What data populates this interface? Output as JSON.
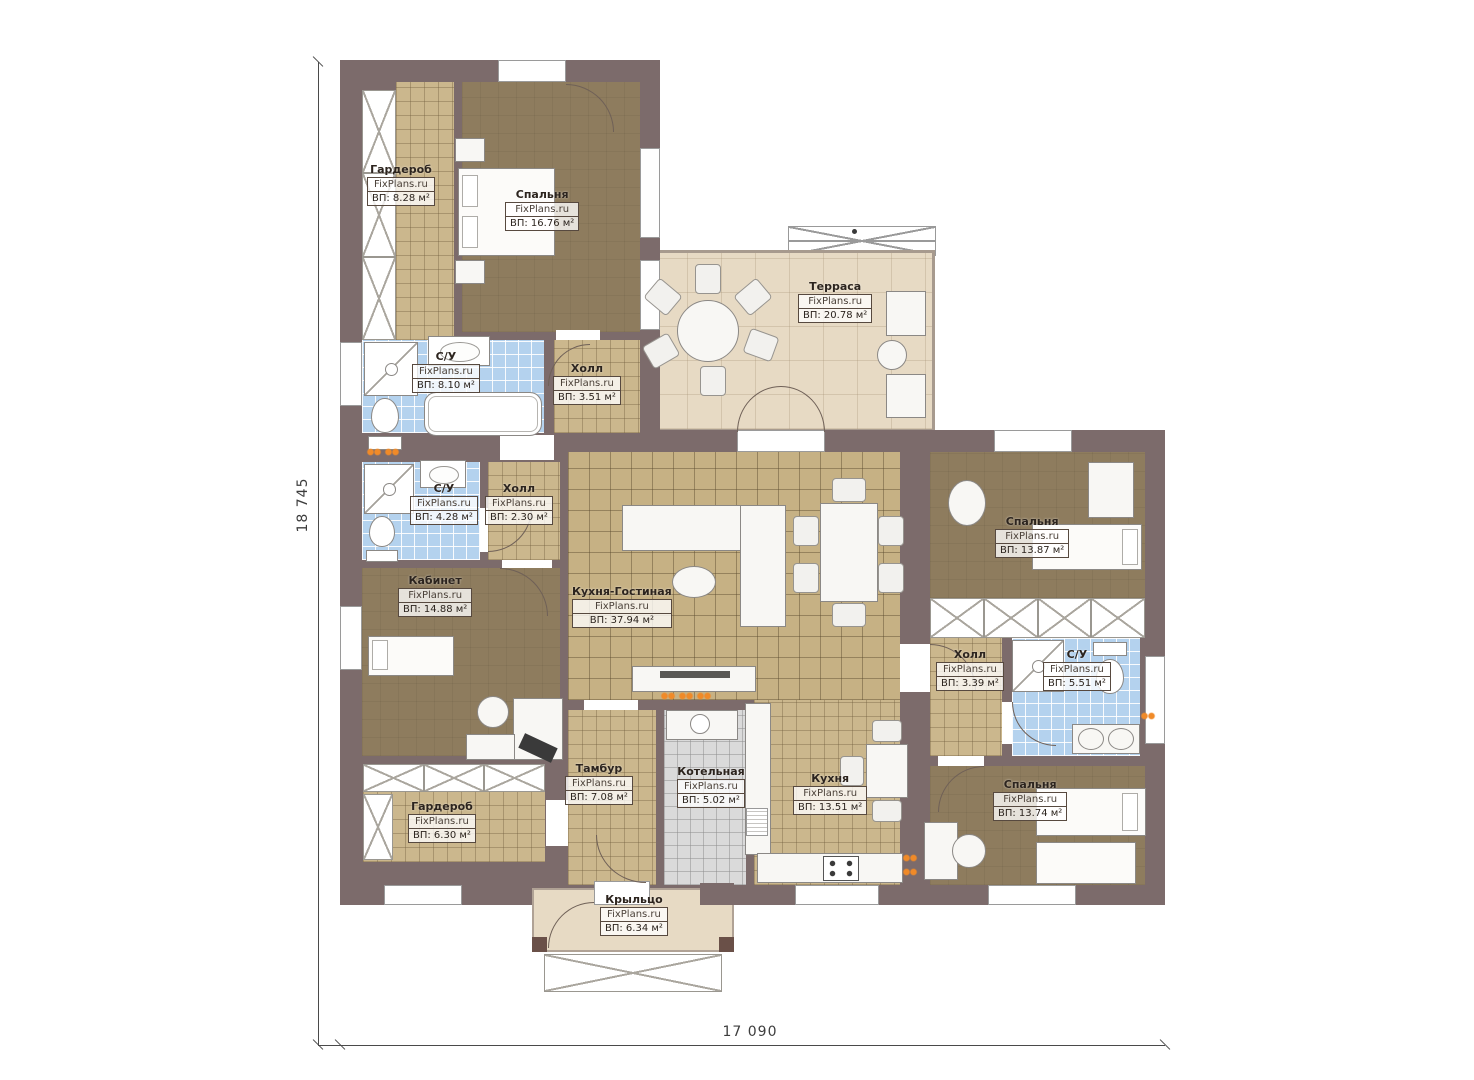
{
  "plan": {
    "watermark": "FixPlans.ru",
    "dimensions": {
      "height_label": "18 745",
      "width_label": "17 090"
    },
    "rooms": [
      {
        "id": "garderob-1",
        "name": "Гардероб",
        "area": "ВП: 8.28 м²"
      },
      {
        "id": "spalnya-1",
        "name": "Спальня",
        "area": "ВП: 16.76 м²"
      },
      {
        "id": "terrasa",
        "name": "Терраса",
        "area": "ВП: 20.78 м²"
      },
      {
        "id": "su-1",
        "name": "С/У",
        "area": "ВП: 8.10 м²"
      },
      {
        "id": "holl-1",
        "name": "Холл",
        "area": "ВП: 3.51 м²"
      },
      {
        "id": "su-2",
        "name": "С/У",
        "area": "ВП: 4.28 м²"
      },
      {
        "id": "holl-2",
        "name": "Холл",
        "area": "ВП: 2.30 м²"
      },
      {
        "id": "kabinet",
        "name": "Кабинет",
        "area": "ВП: 14.88 м²"
      },
      {
        "id": "kuhnya-gostinaya",
        "name": "Кухня-Гостиная",
        "area": "ВП: 37.94 м²"
      },
      {
        "id": "spalnya-2",
        "name": "Спальня",
        "area": "ВП: 13.87 м²"
      },
      {
        "id": "holl-3",
        "name": "Холл",
        "area": "ВП: 3.39 м²"
      },
      {
        "id": "su-3",
        "name": "С/У",
        "area": "ВП: 5.51 м²"
      },
      {
        "id": "tambur",
        "name": "Тамбур",
        "area": "ВП: 7.08 м²"
      },
      {
        "id": "kotelnaya",
        "name": "Котельная",
        "area": "ВП: 5.02 м²"
      },
      {
        "id": "kuhnya",
        "name": "Кухня",
        "area": "ВП: 13.51 м²"
      },
      {
        "id": "garderob-2",
        "name": "Гардероб",
        "area": "ВП: 6.30 м²"
      },
      {
        "id": "spalnya-3",
        "name": "Спальня",
        "area": "ВП: 13.74 м²"
      },
      {
        "id": "krylco",
        "name": "Крыльцо",
        "area": "ВП: 6.34 м²"
      }
    ],
    "colors": {
      "wall": "#7c6b6b",
      "floor_brown": "#8e7c5e",
      "tile_tan": "#cbb78d",
      "tile_blue": "#b4d2ee",
      "tile_gray": "#dadada",
      "terrace": "#e7dac4",
      "radiator": "#f08a28"
    }
  }
}
